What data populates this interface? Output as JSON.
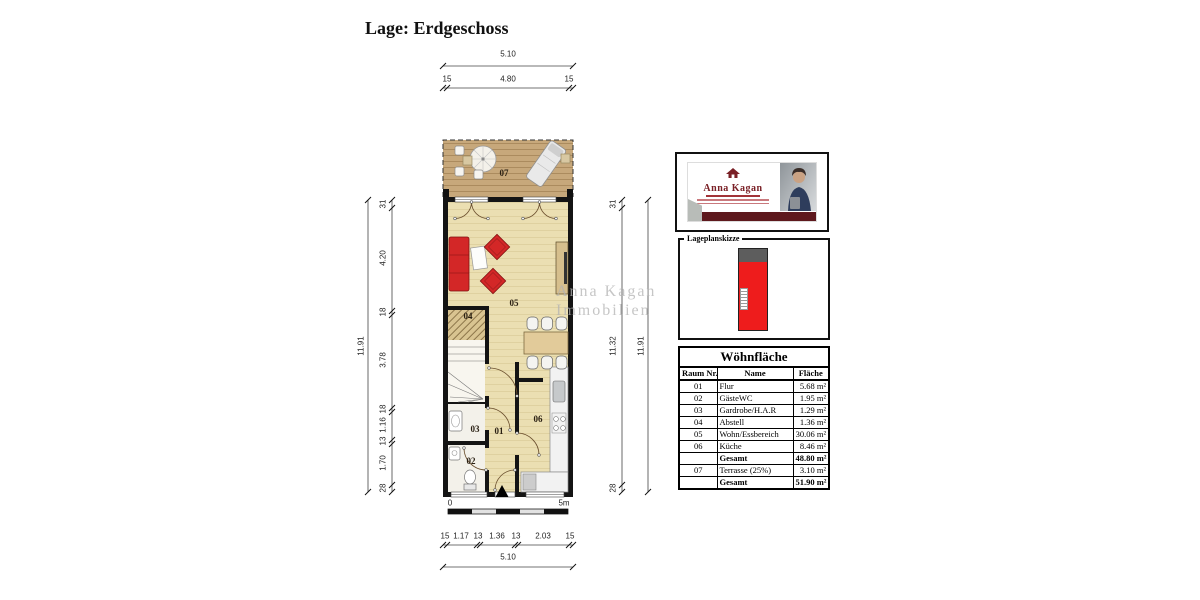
{
  "page": {
    "title": "Lage: Erdgeschoss"
  },
  "watermark": {
    "line1": "Anna Kagan",
    "line2": "Immobilien"
  },
  "logo": {
    "brand": "Anna Kagan"
  },
  "siteplan": {
    "label": "Lageplanskizze"
  },
  "room_labels": {
    "r01": "01",
    "r02": "02",
    "r03": "03",
    "r04": "04",
    "r05": "05",
    "r06": "06",
    "r07": "07"
  },
  "dimensions": {
    "top": {
      "total": "5.10",
      "chain": [
        "15",
        "4.80",
        "15"
      ]
    },
    "bottom": {
      "total": "5.10",
      "chain": [
        "15",
        "1.17",
        "13",
        "1.36",
        "13",
        "2.03",
        "15"
      ]
    },
    "left": {
      "total": "11.91",
      "chain": [
        "31",
        "4.20",
        "18",
        "3.78",
        "18",
        "1.16",
        "13",
        "1.70",
        "28"
      ]
    },
    "right": {
      "total": "11.91",
      "chain": [
        "31",
        "11.32",
        "28"
      ]
    }
  },
  "scalebar": {
    "start": "0",
    "end": "5m"
  },
  "table": {
    "title": "Wöhnfläche",
    "headers": [
      "Raum Nr.",
      "Name",
      "Fläche"
    ],
    "rows": [
      {
        "nr": "01",
        "name": "Flur",
        "area": "5.68 m²"
      },
      {
        "nr": "02",
        "name": "GästeWC",
        "area": "1.95 m²"
      },
      {
        "nr": "03",
        "name": "Gardrobe/H.A.R",
        "area": "1.29 m²"
      },
      {
        "nr": "04",
        "name": "Abstell",
        "area": "1.36 m²"
      },
      {
        "nr": "05",
        "name": "Wohn/Essbereich",
        "area": "30.06 m²"
      },
      {
        "nr": "06",
        "name": "Küche",
        "area": "8.46 m²"
      },
      {
        "nr": "",
        "name": "Gesamt",
        "area": "48.80 m²"
      },
      {
        "nr": "07",
        "name": "Terrasse (25%)",
        "area": "3.10 m²"
      },
      {
        "nr": "",
        "name": "Gesamt",
        "area": "51.90 m²"
      }
    ]
  }
}
